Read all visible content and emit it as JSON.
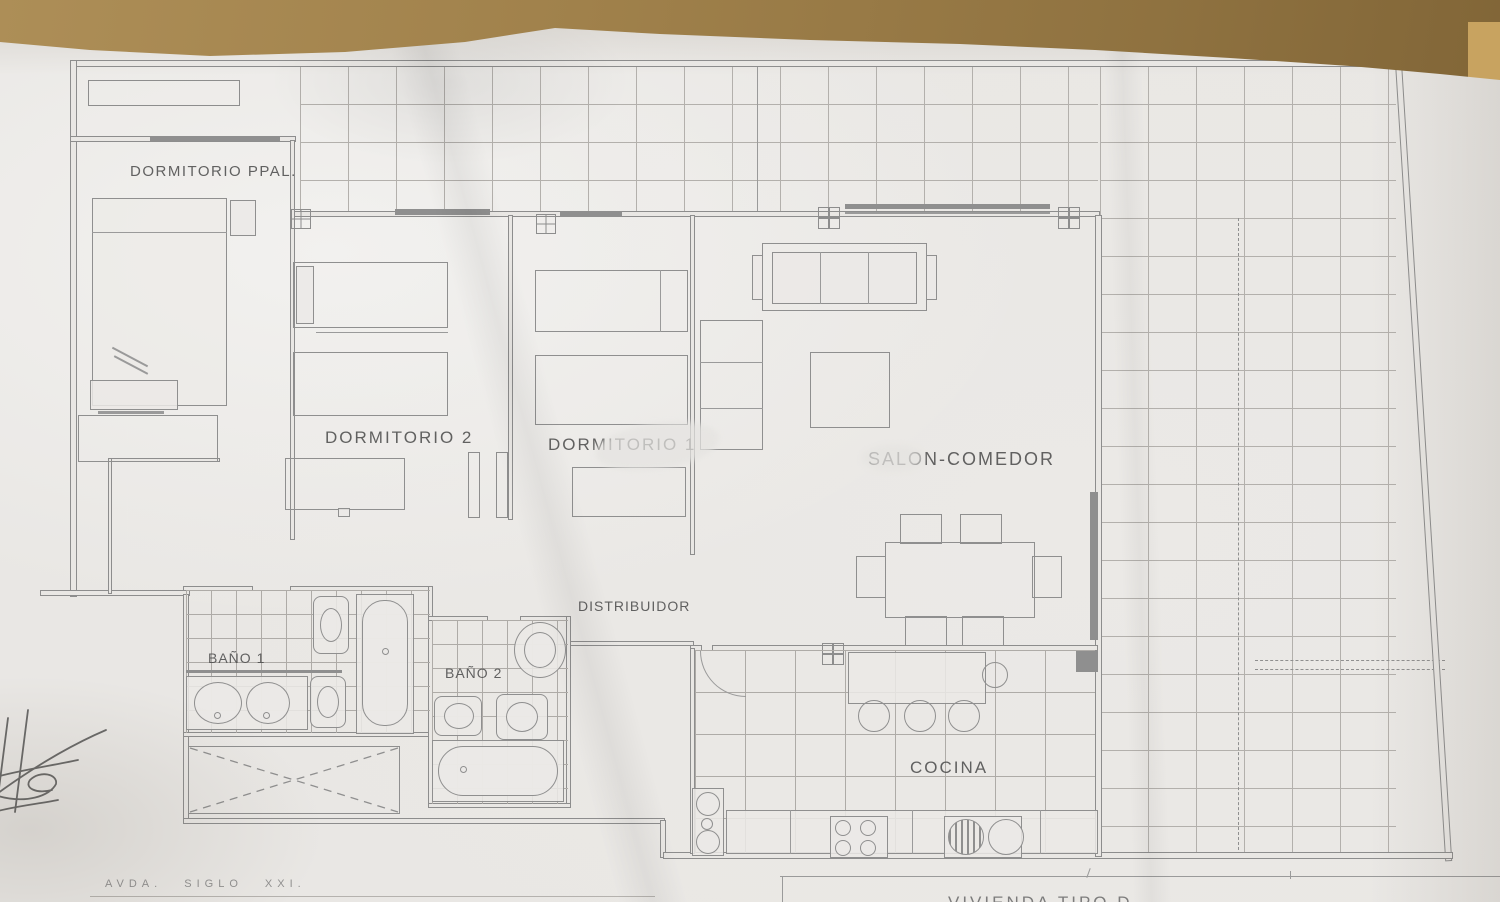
{
  "photo": {
    "surface": "wood-table",
    "colors": {
      "wood": "#9c7d47",
      "paper": "#e9e7e4",
      "ink": "#8d8d8d",
      "text": "#4e4e4e"
    }
  },
  "plan": {
    "rooms": [
      {
        "id": "dormitorio-ppal",
        "label": "DORMITORIO PPAL."
      },
      {
        "id": "dormitorio-2",
        "label": "DORMITORIO 2"
      },
      {
        "id": "dormitorio-1",
        "label": "DORMITORIO 1"
      },
      {
        "id": "salon-comedor",
        "label": "SALON-COMEDOR"
      },
      {
        "id": "distribuidor",
        "label": "DISTRIBUIDOR"
      },
      {
        "id": "bano-1",
        "label": "BAÑO 1"
      },
      {
        "id": "bano-2",
        "label": "BAÑO 2"
      },
      {
        "id": "cocina",
        "label": "COCINA"
      }
    ],
    "annotations": {
      "street": "AVDA.  SIGLO  XXI.",
      "title_block_partial": "VIVIENDA TIPO D"
    }
  }
}
